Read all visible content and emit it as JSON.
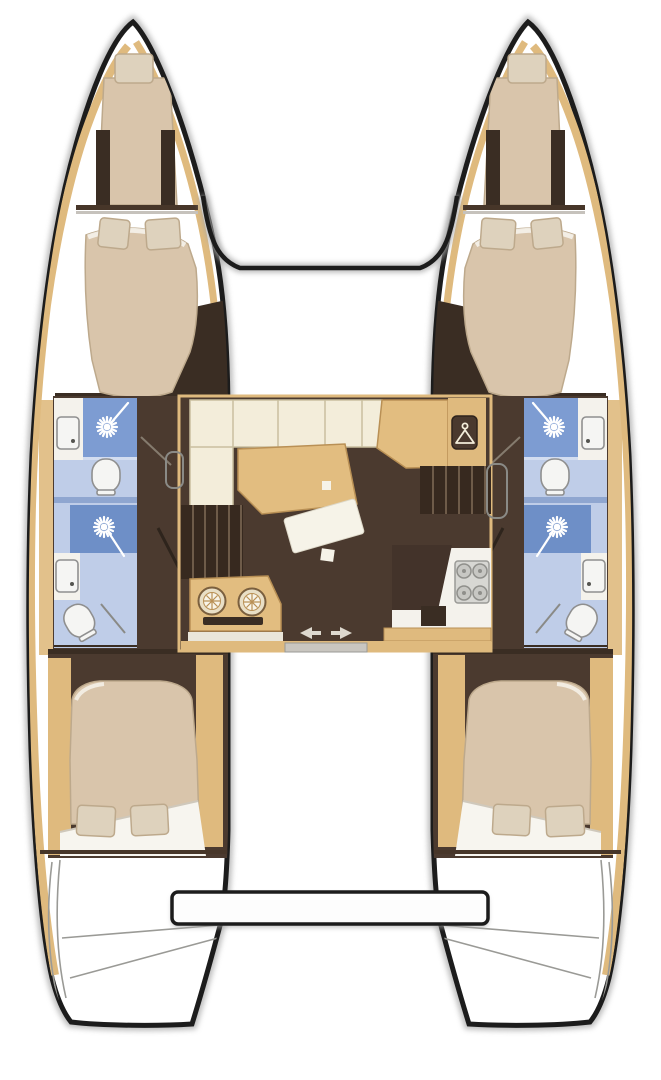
{
  "title": "Catamaran interior layout floor plan (top view)",
  "colors": {
    "outline": "#1c1c1c",
    "shadow": "#a8a8a8",
    "hull_interior": "#4b3a2f",
    "dark_wall": "#3a2d23",
    "wood": "#dfba7e",
    "wood_dark": "#b99055",
    "bed": "#d9c5ab",
    "bed_dark": "#bda98c",
    "pillow": "#ded2bd",
    "sheet": "#f7f5ef",
    "sofa": "#f3edda",
    "table": "#e2bd80",
    "shower_tile": "#7d9cd2",
    "shower_tile_dark": "#6e8fc7",
    "bath_floor": "#bfcde8",
    "bath_floor_light": "#d3ddf0",
    "fixture_white": "#f5f5f3",
    "fixture_stroke": "#8f8f8f",
    "counter_white": "#f4f2ec",
    "stove_gray": "#d7d7d3",
    "burner_gray": "#c7c7c3",
    "step_tread": "#6e5b49"
  },
  "vessel": {
    "view": "top-down deck plan",
    "hulls": [
      {
        "side": "port",
        "rooms": [
          "forepeak-single-berth",
          "forward-double-cabin",
          "forward-head-with-shower-and-toilet",
          "aft-head-with-shower-and-toilet",
          "aft-double-cabin",
          "transom-steps"
        ]
      },
      {
        "side": "starboard",
        "rooms": [
          "forepeak-single-berth",
          "forward-double-cabin",
          "forward-head-with-shower-and-toilet",
          "aft-head-with-shower-and-toilet",
          "aft-double-cabin",
          "transom-steps"
        ]
      }
    ],
    "bridgedeck": {
      "rooms": [
        "salon-l-shaped-sofa",
        "salon-table",
        "floor-cushion",
        "hanging-locker-with-hanger-symbol",
        "port-companionway-steps",
        "starboard-companionway-steps",
        "galley-sink-unit-two-bowls",
        "galley-counter-with-four-burner-stove",
        "sliding-entry-door-with-arrows",
        "forward-crossbeam",
        "aft-platform-beam"
      ]
    },
    "fixture_counts": {
      "double-beds": 4,
      "single-berths": 2,
      "toilets": 4,
      "showers": 4,
      "sinks": 4,
      "stove-burners": 4
    }
  },
  "icons": [
    "shower-head-starburst-icon",
    "toilet-icon",
    "washbasin-icon",
    "stove-burner-icon",
    "clothes-hanger-icon",
    "sliding-door-arrow-icons"
  ]
}
